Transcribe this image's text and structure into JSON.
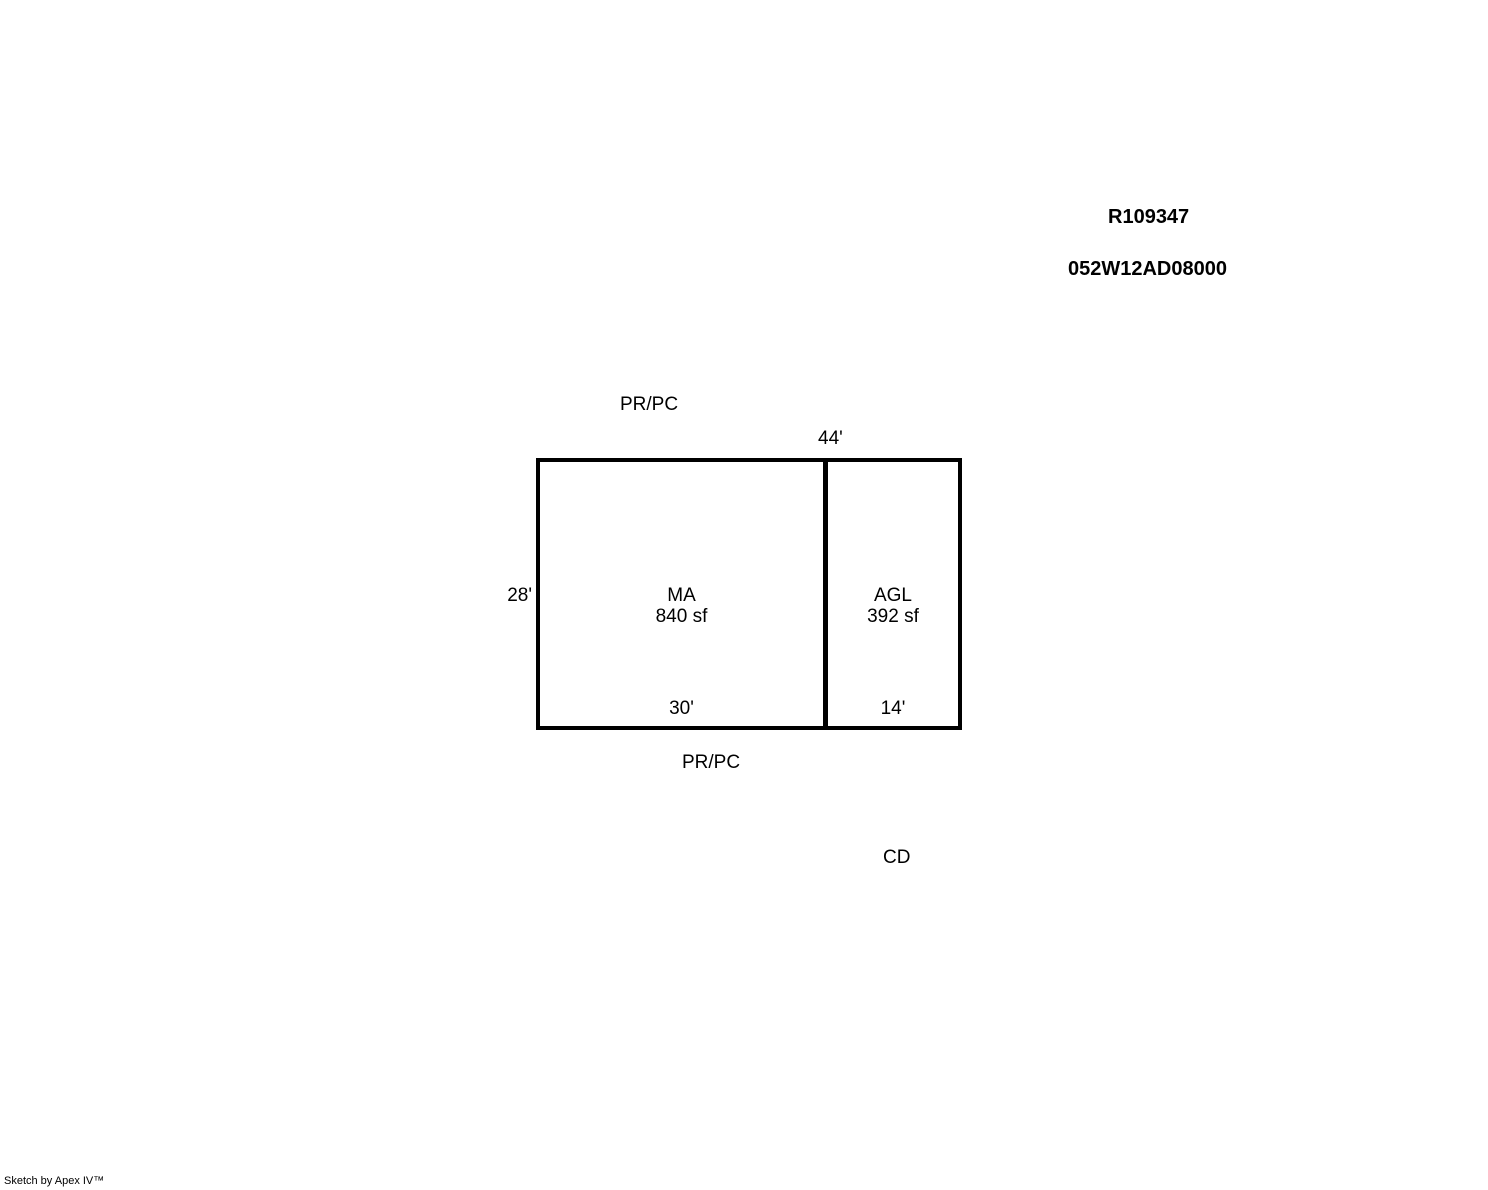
{
  "page": {
    "background": "#ffffff",
    "text_color": "#000000",
    "line_color": "#000000"
  },
  "header": {
    "record_id": "R109347",
    "parcel_id": "052W12AD08000"
  },
  "sketch": {
    "top_boundary_label": "PR/PC",
    "bottom_boundary_label": "PR/PC",
    "side_label": "CD",
    "total_width_dim": "44'",
    "left_height_dim": "28'",
    "sections": [
      {
        "code": "MA",
        "area": "840 sf",
        "width_dim": "30'"
      },
      {
        "code": "AGL",
        "area": "392 sf",
        "width_dim": "14'"
      }
    ]
  },
  "footer": {
    "credit": "Sketch by Apex IV™"
  }
}
